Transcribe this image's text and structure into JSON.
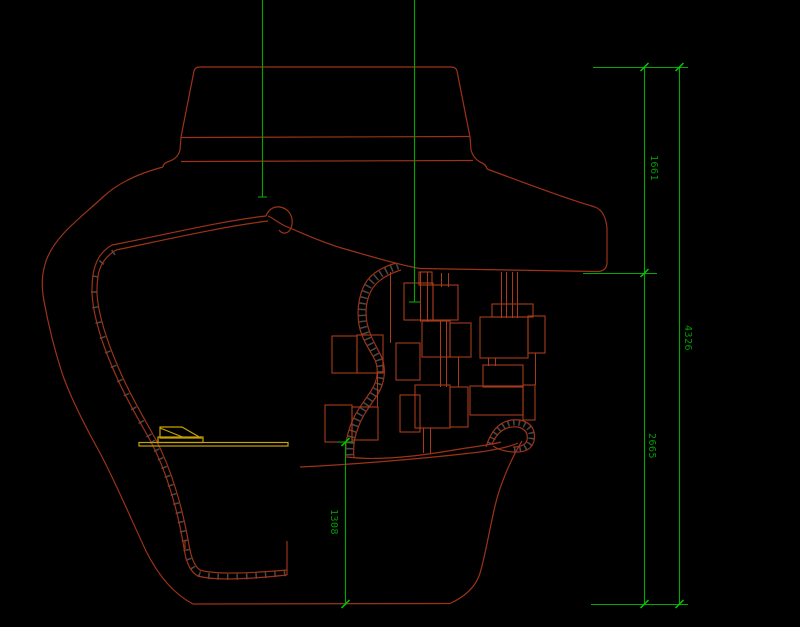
{
  "drawing": {
    "title": "cad-section-drawing",
    "background": "#000000",
    "colors": {
      "outline_red": "#9c3318",
      "box_red": "#a83a1c",
      "dimension_green": "#00a800",
      "tick_green": "#00cc00",
      "text_green": "#009c00",
      "platform_yellow": "#c8a202",
      "hatch_gray": "#4a4a4a"
    },
    "dimensions": [
      {
        "id": "dim-top-right-upper",
        "value": "1661"
      },
      {
        "id": "dim-right-total",
        "value": "4326"
      },
      {
        "id": "dim-right-lower",
        "value": "2665"
      },
      {
        "id": "dim-floor-to-base",
        "value": "1308"
      }
    ]
  }
}
